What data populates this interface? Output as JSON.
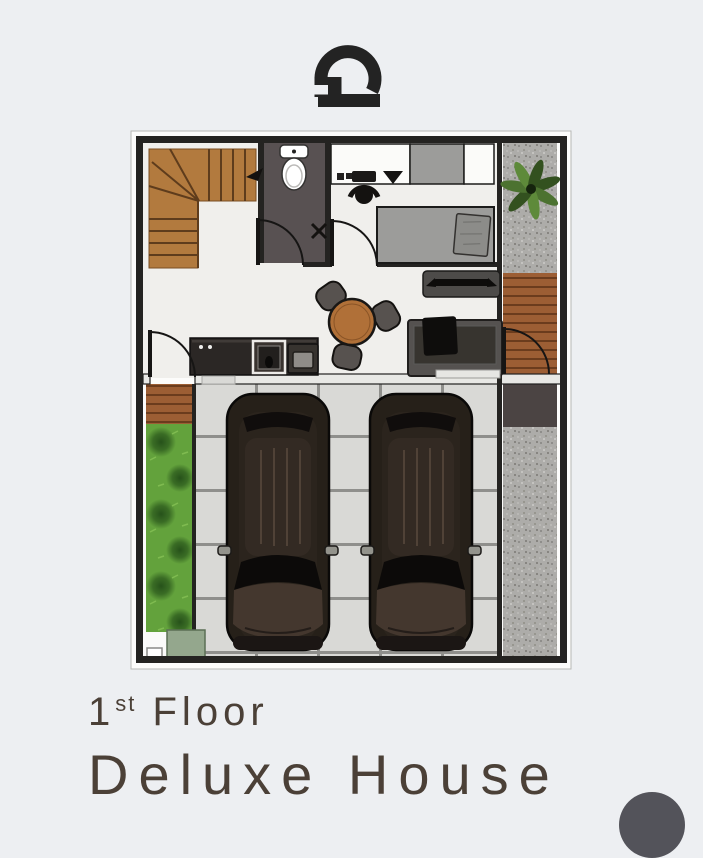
{
  "page": {
    "background": "#edeff2",
    "width": 703,
    "height": 804
  },
  "logo": {
    "icon": "arch-gate-logo",
    "color": "#232323"
  },
  "caption": {
    "floor_number": "1",
    "floor_suffix": "st",
    "floor_word": "Floor",
    "house_name": "Deluxe House",
    "text_color": "#4b4037"
  },
  "floor_plan": {
    "kind": "top-view architectural floor plan",
    "rooms": [
      "staircase",
      "bathroom",
      "bedroom",
      "living-dining",
      "kitchen",
      "carport",
      "side-deck",
      "garden-strip",
      "gravel-strip"
    ],
    "items": [
      "toilet",
      "bed",
      "pillow",
      "wardrobe",
      "desk-counter",
      "desk-chair",
      "dining-table",
      "dining-chairs",
      "sofa",
      "tv-console",
      "kitchen-counter",
      "oven",
      "microwave",
      "door-swings",
      "car",
      "car",
      "palm-plant",
      "planter-box",
      "paving-tiles"
    ],
    "car_count": 2,
    "colors": {
      "wall": "#242321",
      "interior_floor": "#f0efec",
      "bathroom_floor": "#585152",
      "wood_stairs": "#b27a3e",
      "wood_line": "#5e3c1c",
      "wood_table": "#b07038",
      "deck": "#9c5e34",
      "deck_line": "#6b3c1d",
      "tile": "#d9d9d6",
      "tile_grout": "#8f8f8c",
      "grass": "#63a23c",
      "grass_dark": "#2c5a1d",
      "gravel": "#adaca9",
      "furniture_gray": "#9c9c9a",
      "sofa_gray": "#555250",
      "seat_black": "#0e0d0c",
      "car_body": "#262019",
      "car_hood": "#44372e",
      "counter_dark": "#2b2725",
      "pad_dark": "#4b4443",
      "planter": "#94a78d",
      "door_line": "#161514",
      "backing": "#fcfcfb"
    }
  },
  "fab": {
    "color": "#53535a"
  }
}
